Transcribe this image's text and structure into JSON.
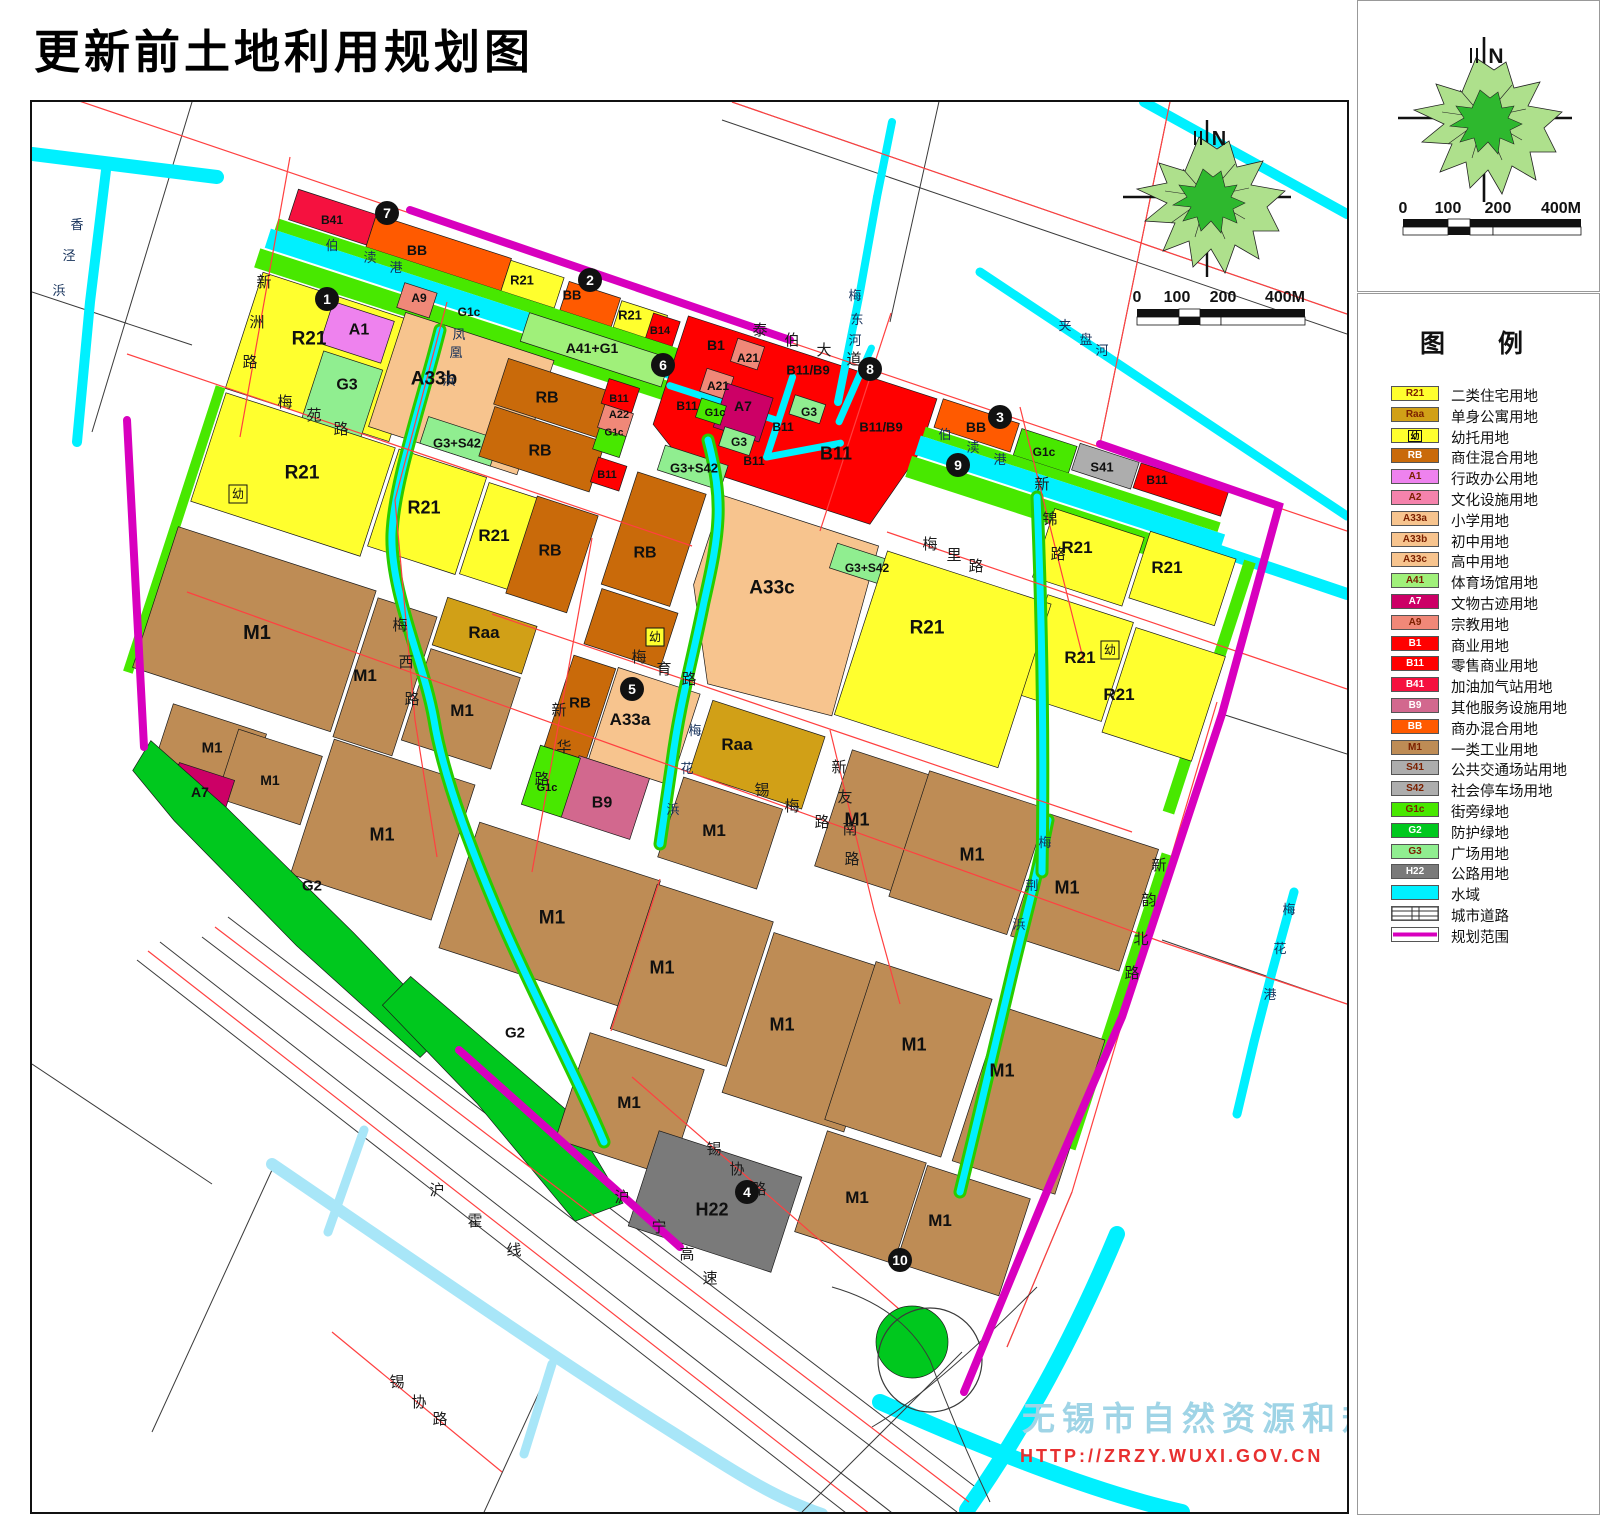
{
  "title": "更新前土地利用规划图",
  "compass": {
    "n": "N"
  },
  "scale": {
    "ticks": [
      "0",
      "100",
      "200",
      "400M"
    ]
  },
  "watermark": {
    "line1": "无锡市自然资源和规划局",
    "line2": "HTTP://ZRZY.WUXI.GOV.CN"
  },
  "legend": {
    "title": "图　例",
    "items": [
      {
        "code": "R21",
        "label": "二类住宅用地",
        "color": "#FFFF2E",
        "type": "color",
        "dark": false
      },
      {
        "code": "Raa",
        "label": "单身公寓用地",
        "color": "#D1A017",
        "type": "color",
        "dark": false
      },
      {
        "code": "幼",
        "label": "幼托用地",
        "color": "#FFFF2E",
        "type": "kid",
        "dark": false
      },
      {
        "code": "RB",
        "label": "商住混合用地",
        "color": "#C96A0A",
        "type": "color",
        "dark": true
      },
      {
        "code": "A1",
        "label": "行政办公用地",
        "color": "#EE82EE",
        "type": "color",
        "dark": false
      },
      {
        "code": "A2",
        "label": "文化设施用地",
        "color": "#F583AC",
        "type": "color",
        "dark": false
      },
      {
        "code": "A33a",
        "label": "小学用地",
        "color": "#F7C48E",
        "type": "color",
        "dark": false
      },
      {
        "code": "A33b",
        "label": "初中用地",
        "color": "#F7C48E",
        "type": "color",
        "dark": false
      },
      {
        "code": "A33c",
        "label": "高中用地",
        "color": "#F7C48E",
        "type": "color",
        "dark": false
      },
      {
        "code": "A41",
        "label": "体育场馆用地",
        "color": "#A0F07A",
        "type": "color",
        "dark": false
      },
      {
        "code": "A7",
        "label": "文物古迹用地",
        "color": "#CC0066",
        "type": "color",
        "dark": true
      },
      {
        "code": "A9",
        "label": "宗教用地",
        "color": "#F08878",
        "type": "color",
        "dark": false
      },
      {
        "code": "B1",
        "label": "商业用地",
        "color": "#FF0000",
        "type": "color",
        "dark": true
      },
      {
        "code": "B11",
        "label": "零售商业用地",
        "color": "#FF0000",
        "type": "color",
        "dark": true
      },
      {
        "code": "B41",
        "label": "加油加气站用地",
        "color": "#F5113F",
        "type": "color",
        "dark": true
      },
      {
        "code": "B9",
        "label": "其他服务设施用地",
        "color": "#D2688E",
        "type": "color",
        "dark": true
      },
      {
        "code": "BB",
        "label": "商办混合用地",
        "color": "#FF5A00",
        "type": "color",
        "dark": true
      },
      {
        "code": "M1",
        "label": "一类工业用地",
        "color": "#BE8C55",
        "type": "color",
        "dark": false
      },
      {
        "code": "S41",
        "label": "公共交通场站用地",
        "color": "#ADADAD",
        "type": "color",
        "dark": false
      },
      {
        "code": "S42",
        "label": "社会停车场用地",
        "color": "#ADADAD",
        "type": "color",
        "dark": false
      },
      {
        "code": "G1c",
        "label": "街旁绿地",
        "color": "#48E800",
        "type": "color",
        "dark": false
      },
      {
        "code": "G2",
        "label": "防护绿地",
        "color": "#00C81E",
        "type": "color",
        "dark": true
      },
      {
        "code": "G3",
        "label": "广场用地",
        "color": "#90EE90",
        "type": "color",
        "dark": false
      },
      {
        "code": "H22",
        "label": "公路用地",
        "color": "#7A7A7A",
        "type": "color",
        "dark": true
      },
      {
        "code": "",
        "label": "水域",
        "color": "#00F0FF",
        "type": "water",
        "dark": false
      },
      {
        "code": "",
        "label": "城市道路",
        "color": "#FFFFFF",
        "type": "road",
        "dark": false
      },
      {
        "code": "",
        "label": "规划范围",
        "color": "#D800BE",
        "type": "boundary",
        "dark": false
      }
    ]
  },
  "map": {
    "parcel_labels": [
      "B41",
      "BB",
      "R21",
      "BB",
      "R21",
      "B14",
      "A9",
      "G1c",
      "R21",
      "A1",
      "G3",
      "A33b",
      "G3+S42",
      "A41+G1",
      "RB",
      "RB",
      "B11",
      "A22",
      "G1c",
      "B1",
      "A21",
      "B11/B9",
      "A21",
      "A7",
      "G1c",
      "B11",
      "G3",
      "B11",
      "G3",
      "B11",
      "B11",
      "B11/B9",
      "BB",
      "G1c",
      "S41",
      "B11",
      "G3+S42",
      "R21",
      "R21",
      "R21",
      "RB",
      "B11",
      "RB",
      "G3+S42",
      "A33c",
      "R21",
      "R21",
      "R21",
      "R21",
      "R21",
      "M1",
      "M1",
      "Raa",
      "M1",
      "RB",
      "A33a",
      "Raa",
      "M1",
      "B9",
      "G1c",
      "M1",
      "M1",
      "M1",
      "M1",
      "M1",
      "A7",
      "G2",
      "M1",
      "M1",
      "M1",
      "M1",
      "M1",
      "M1",
      "G2",
      "M1",
      "H22",
      "M1",
      "M1"
    ],
    "kid_label": "幼",
    "road_names": [
      "新洲路",
      "梅苑路",
      "泰伯大道",
      "梅里路",
      "梅育路",
      "梅西路",
      "新华路",
      "新锦路",
      "新友南路",
      "锡梅路",
      "新韵北路",
      "锡协路",
      "沪宁高速",
      "沪霍线"
    ],
    "river_names": [
      "香泾浜",
      "伯渎港",
      "凤凰浜",
      "梅东河",
      "夹盘河",
      "梅花浜",
      "梅荆浜",
      "梅花港"
    ],
    "markers": [
      "1",
      "2",
      "3",
      "4",
      "5",
      "6",
      "7",
      "8",
      "9",
      "10"
    ]
  }
}
